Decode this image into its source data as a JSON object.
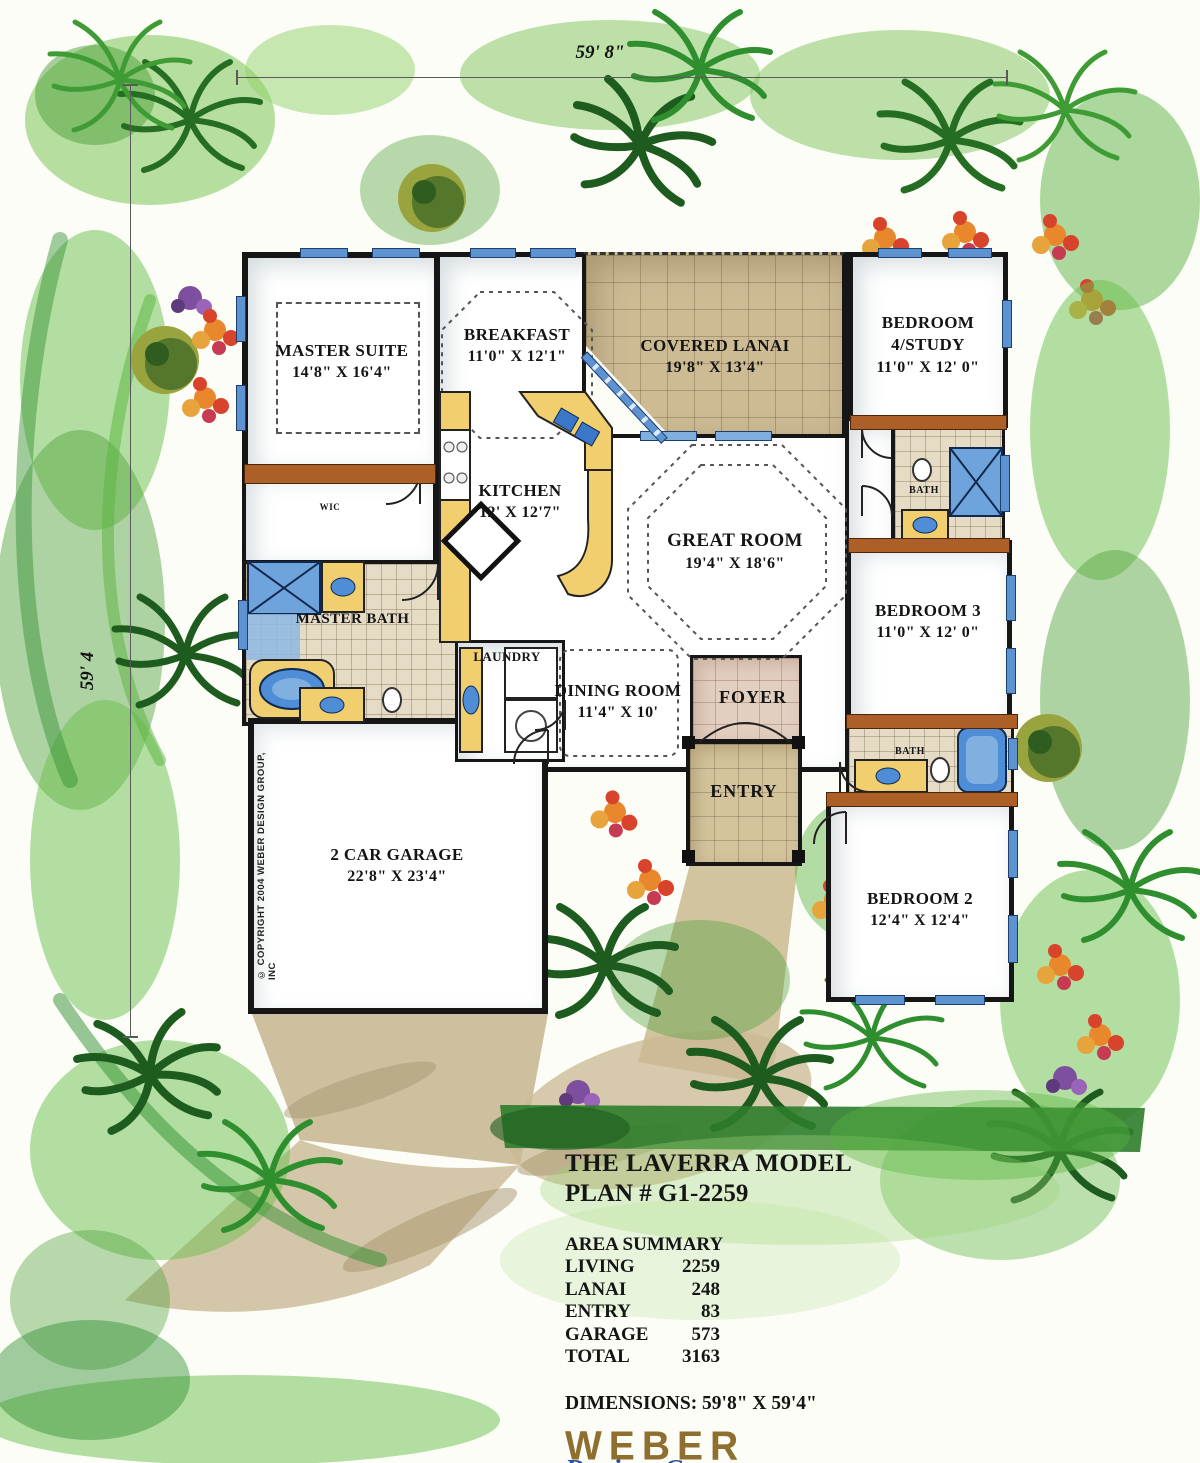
{
  "dimensions": {
    "top": "59' 8\"",
    "left": "59' 4"
  },
  "rooms": {
    "master_suite": {
      "name": "MASTER SUITE",
      "size": "14'8\" X 16'4\""
    },
    "breakfast": {
      "name": "BREAKFAST",
      "size": "11'0\" X 12'1\""
    },
    "covered_lanai": {
      "name": "COVERED LANAI",
      "size": "19'8\" X 13'4\""
    },
    "bedroom4": {
      "name": "BEDROOM 4/STUDY",
      "size": "11'0\" X 12' 0\""
    },
    "kitchen": {
      "name": "KITCHEN",
      "size": "12' X 12'7\""
    },
    "great_room": {
      "name": "GREAT ROOM",
      "size": "19'4\" X 18'6\""
    },
    "bedroom3": {
      "name": "BEDROOM 3",
      "size": "11'0\" X 12' 0\""
    },
    "master_bath": {
      "name": "MASTER BATH"
    },
    "wic": {
      "name": "WIC"
    },
    "laundry": {
      "name": "LAUNDRY"
    },
    "dining": {
      "name": "DINING ROOM",
      "size": "11'4\" X 10'"
    },
    "foyer": {
      "name": "FOYER"
    },
    "entry": {
      "name": "ENTRY"
    },
    "bath_upper": {
      "name": "BATH"
    },
    "bath_lower": {
      "name": "BATH"
    },
    "bedroom2": {
      "name": "BEDROOM 2",
      "size": "12'4\" X 12'4\""
    },
    "garage": {
      "name": "2 CAR GARAGE",
      "size": "22'8\" X 23'4\""
    }
  },
  "title_block": {
    "model": "THE LAVERRA MODEL",
    "plan": "PLAN # G1-2259",
    "area_summary_title": "AREA SUMMARY",
    "areas": [
      {
        "label": "LIVING",
        "value": "2259"
      },
      {
        "label": "LANAI",
        "value": "248"
      },
      {
        "label": "ENTRY",
        "value": "83"
      },
      {
        "label": "GARAGE",
        "value": "573"
      },
      {
        "label": "TOTAL",
        "value": "3163"
      }
    ],
    "dimensions_line": "DIMENSIONS: 59'8\" X 59'4\""
  },
  "logo": {
    "line1": "WEBER",
    "line2": "Design  Group",
    "url": "www.WeberDesignGroup.com"
  },
  "copyright": "© COPYRIGHT 2004 WEBER DESIGN GROUP, INC",
  "colors": {
    "logo_gold": "#8f6f2f",
    "logo_blue": "#2b4ea0",
    "landscape_green": "#4da03a",
    "landscape_dark_green": "#1d5c1e",
    "tile_tan": "#cdbb94",
    "water_blue": "#5d93d1",
    "wood_brown": "#ad5f28",
    "counter_yellow": "#f2cf6e",
    "wall_black": "#161616"
  }
}
